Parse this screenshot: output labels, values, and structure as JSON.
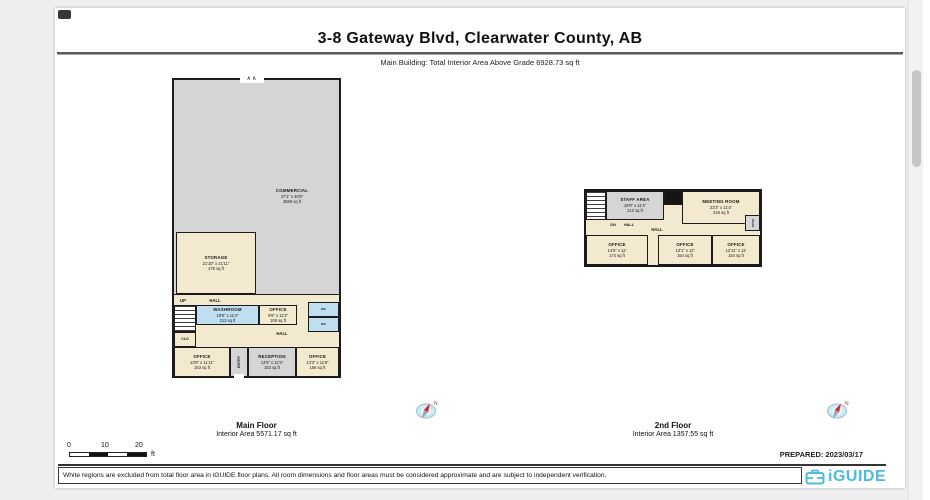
{
  "page": {
    "title": "3-8 Gateway Blvd, Clearwater County, AB",
    "subtitle": "Main Building: Total Interior Area Above Grade 6928.73 sq ft",
    "prepared": "PREPARED: 2023/03/17",
    "disclaimer": "White regions are excluded from total floor area in iGUIDE floor plans. All room dimensions and floor areas must be considered approximate and are subject to independent verification.",
    "brand": "iGUIDE",
    "compass_n": "N",
    "scale": {
      "t0": "0",
      "t10": "10",
      "t20": "20",
      "unit": "ft"
    }
  },
  "colors": {
    "brand_blue": "#4cbbe0",
    "room_cream": "#f2e9cf",
    "room_gray": "#d5d5d5",
    "room_blue": "#bfdeef",
    "wall": "#1b1b1b",
    "compass_red": "#cc2b2b"
  },
  "floors": [
    {
      "name": "Main Floor",
      "area": "Interior Area 5571.17 sq ft",
      "rooms": {
        "commercial": {
          "name": "COMMERCIAL",
          "dims": "47'1\" x 49'5\"",
          "area": "3559 sq ft"
        },
        "storage": {
          "name": "STORAGE",
          "dims": "21'10\" x 21'11\"",
          "area": "479 sq ft"
        },
        "hall_upper": {
          "name": "HALL"
        },
        "up": {
          "name": "UP"
        },
        "washroom": {
          "name": "WASHROOM",
          "dims": "18'9\" x 11'4\"",
          "area": "212 sq ft"
        },
        "office_mid": {
          "name": "OFFICE",
          "dims": "9'9\" x 11'3\"",
          "area": "109 sq ft"
        },
        "wc_upper": {
          "name": "WC"
        },
        "wc_lower": {
          "name": "WC"
        },
        "clo": {
          "name": "CLO"
        },
        "hall_lower": {
          "name": "HALL"
        },
        "office_left": {
          "name": "OFFICE",
          "dims": "13'8\" x 11'11\"",
          "area": "163 sq ft"
        },
        "entry": {
          "name": "ENTRY"
        },
        "reception": {
          "name": "RECEPTION",
          "dims": "13'5\" x 12'4\"",
          "area": "163 sq ft"
        },
        "office_right": {
          "name": "OFFICE",
          "dims": "13'3\" x 11'9\"",
          "area": "156 sq ft"
        }
      }
    },
    {
      "name": "2nd Floor",
      "area": "Interior Area 1357.55 sq ft",
      "rooms": {
        "staff_area": {
          "name": "STAFF AREA",
          "dims": "18'9\" x 11'4\"",
          "area": "212 sq ft"
        },
        "meeting_room": {
          "name": "MEETING ROOM",
          "dims": "23'3\" x 11'4\"",
          "area": "246 sq ft"
        },
        "dn": {
          "name": "DN"
        },
        "hall_small": {
          "name": "HALL"
        },
        "hall": {
          "name": "HALL"
        },
        "office_1": {
          "name": "OFFICE",
          "dims": "14'6\" x 12'",
          "area": "174 sq ft"
        },
        "office_2": {
          "name": "OFFICE",
          "dims": "13'1\" x 12'",
          "area": "154 sq ft"
        },
        "office_3": {
          "name": "OFFICE",
          "dims": "12'11\" x 12'",
          "area": "154 sq ft"
        },
        "stor": {
          "name": "STOR"
        }
      }
    }
  ]
}
